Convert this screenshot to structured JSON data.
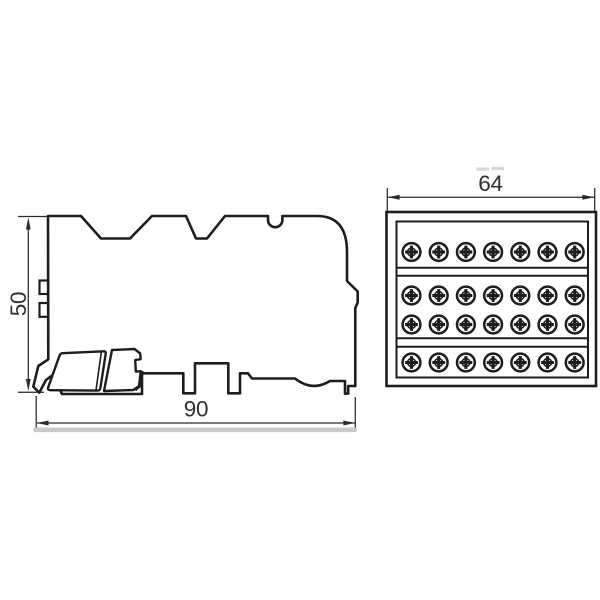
{
  "page": {
    "background": "#ffffff"
  },
  "drawing": {
    "line_color": "#1d1d1d",
    "dim_color": "#2a2a2a",
    "text_color": "#303030",
    "shadow_color": "#c9c9c9",
    "side_view": {
      "height_dim": "50",
      "width_dim": "90"
    },
    "front_view": {
      "width_dim": "64",
      "screw_rows": 4,
      "screw_cols": 7,
      "screw_total": 28
    }
  }
}
